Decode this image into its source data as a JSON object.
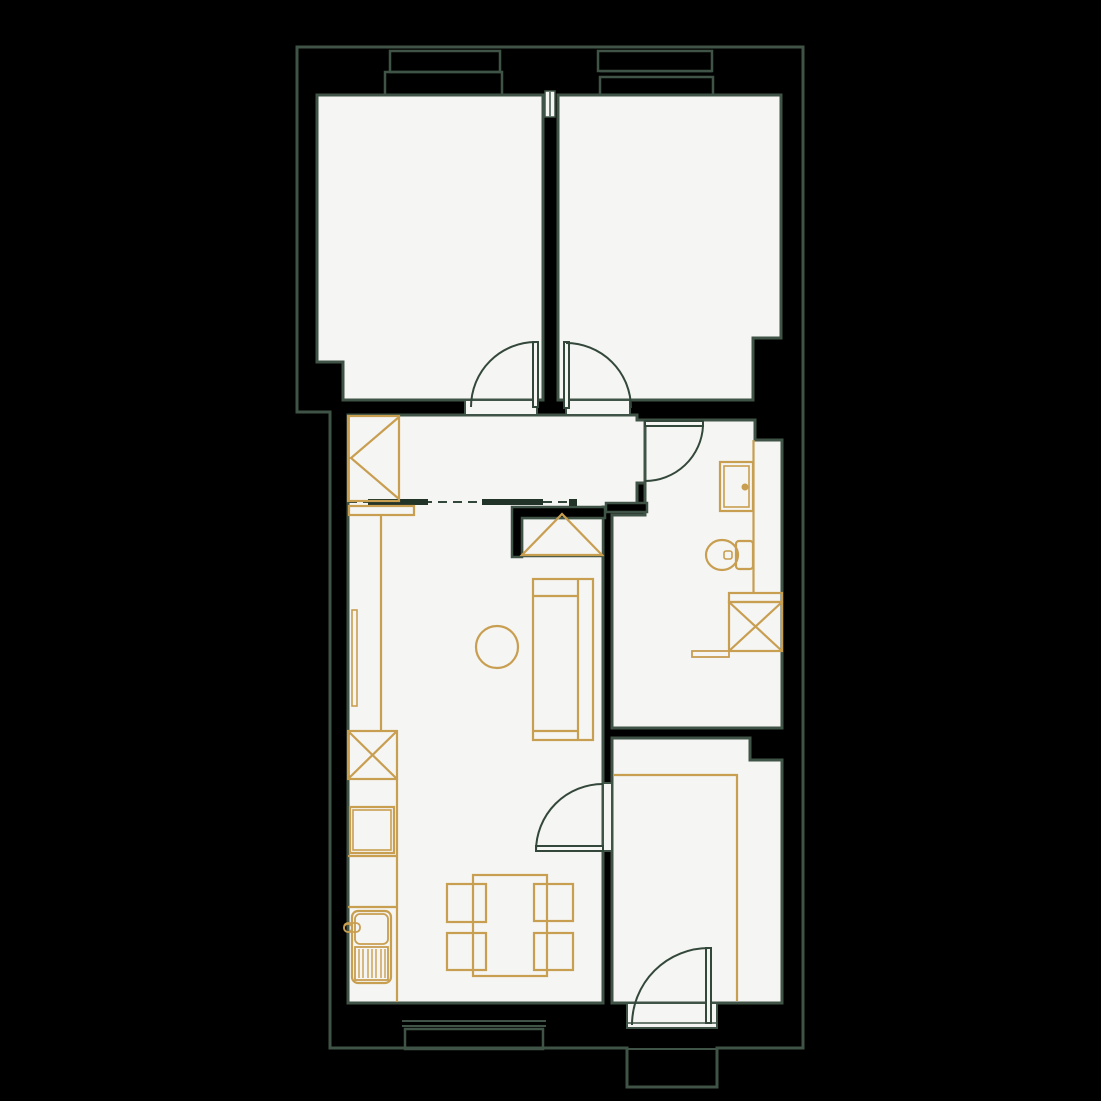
{
  "palette": {
    "bg": "#000000",
    "line": "#3f5446",
    "door": "#33473a",
    "floor": "#f5f5f3",
    "gold": "#c89e50",
    "beam": "#223428"
  },
  "canvas": {
    "width": 1101,
    "height": 1101
  },
  "layers": [
    {
      "name": "floors",
      "style": {
        "f": "$floor",
        "s": "$line",
        "w": 3
      },
      "shapes": [
        {
          "n": "bedroom-left-floor",
          "k": "path",
          "d": "M317,95 H543 V400 H343 V362 H317 Z"
        },
        {
          "n": "bedroom-right-floor",
          "k": "path",
          "d": "M558,95 H781 V338 H753 V400 H558 Z"
        },
        {
          "n": "hall-living-floor",
          "k": "path",
          "d": "M348,415 H637 V420 H645 V483 H637 V507 H603 V1003 H348 Z"
        },
        {
          "n": "bathroom-floor",
          "k": "path",
          "d": "M645,420 H755 V440 H782 V728 H612 V515 H645 Z"
        },
        {
          "n": "bottom-room-floor",
          "k": "path",
          "d": "M612,738 H750 V760 H782 V1003 H612 Z"
        },
        {
          "n": "closet-niche-floor",
          "k": "rect",
          "x": 522,
          "y": 518,
          "wd": 81,
          "h": 38,
          "w": 2.5
        },
        {
          "n": "threshold-bedroom-left-door",
          "k": "rect",
          "x": 465,
          "y": 400,
          "wd": 72,
          "h": 15,
          "w": 2
        },
        {
          "n": "threshold-bedroom-right-door",
          "k": "rect",
          "x": 566,
          "y": 400,
          "wd": 64,
          "h": 15,
          "w": 2
        },
        {
          "n": "threshold-bottom-room-door",
          "k": "rect",
          "x": 603,
          "y": 783,
          "wd": 9,
          "h": 68,
          "w": 2
        },
        {
          "n": "threshold-entry-door",
          "k": "rect",
          "x": 627,
          "y": 1003,
          "wd": 90,
          "h": 25,
          "w": 2
        },
        {
          "n": "wall-cap-between-windows",
          "k": "rect",
          "x": 545,
          "y": 91,
          "wd": 10,
          "h": 26,
          "w": 1.5
        }
      ]
    },
    {
      "name": "interior-walls",
      "style": {
        "f": "$bg",
        "s": "$line",
        "w": 2.5
      },
      "shapes": [
        {
          "n": "closet-wall",
          "k": "path",
          "d": "M512,507 H605 V518 H522 V557 H512 Z"
        },
        {
          "n": "hall-bathroom-wall",
          "k": "rect",
          "x": 606,
          "y": 503,
          "wd": 41,
          "h": 9
        }
      ]
    },
    {
      "name": "outer-boundary",
      "style": {
        "f": "none",
        "s": "$line",
        "w": 3
      },
      "shapes": [
        {
          "n": "building-outline",
          "k": "path",
          "d": "M297,47 H803 V1048 H717 V1087 H627 V1048 H330 V412 H297 Z"
        }
      ]
    },
    {
      "name": "windows",
      "style": {
        "f": "none",
        "s": "$line",
        "w": 2.5
      },
      "shapes": [
        {
          "n": "window-left-frame",
          "k": "rect",
          "x": 390,
          "y": 51,
          "wd": 110,
          "h": 21
        },
        {
          "n": "window-left-sill",
          "k": "rect",
          "x": 385,
          "y": 72,
          "wd": 117,
          "h": 23
        },
        {
          "n": "window-right-frame",
          "k": "rect",
          "x": 598,
          "y": 51,
          "wd": 114,
          "h": 20
        },
        {
          "n": "window-right-glass-line",
          "k": "line",
          "x1": 600,
          "y1": 71.5,
          "x2": 712,
          "y2": 71.5,
          "w": 1.5
        },
        {
          "n": "window-right-sill",
          "k": "rect",
          "x": 600,
          "y": 77,
          "wd": 113,
          "h": 18
        },
        {
          "n": "window-bottom-glass-line-a",
          "k": "line",
          "x1": 402,
          "y1": 1021,
          "x2": 546,
          "y2": 1021,
          "w": 2
        },
        {
          "n": "window-bottom-glass-line-b",
          "k": "line",
          "x1": 402,
          "y1": 1026,
          "x2": 546,
          "y2": 1026,
          "w": 2
        },
        {
          "n": "window-bottom-sill",
          "k": "rect",
          "x": 405,
          "y": 1029,
          "wd": 138,
          "h": 20
        },
        {
          "n": "wall-cap-line",
          "k": "line",
          "x1": 550,
          "y1": 92,
          "x2": 550,
          "y2": 116,
          "w": 1.5
        },
        {
          "n": "entry-step-line",
          "k": "line",
          "x1": 627,
          "y1": 1049,
          "x2": 717,
          "y2": 1049,
          "w": 2
        },
        {
          "n": "entry-threshold-line",
          "k": "line",
          "x1": 627,
          "y1": 1023,
          "x2": 717,
          "y2": 1023,
          "w": 1.5
        }
      ]
    },
    {
      "name": "open-plan-markers",
      "style": {
        "f": "none",
        "s": "$door",
        "w": 2
      },
      "shapes": [
        {
          "n": "open-boundary-dashed-line",
          "k": "line",
          "x1": 348,
          "y1": 502,
          "x2": 575,
          "y2": 502,
          "dash": "9 6"
        },
        {
          "n": "ceiling-beam-a",
          "k": "rect",
          "x": 368,
          "y": 499,
          "wd": 60,
          "h": 6,
          "f": "$beam",
          "s": "none"
        },
        {
          "n": "ceiling-beam-b",
          "k": "rect",
          "x": 482,
          "y": 499,
          "wd": 61,
          "h": 6,
          "f": "$beam",
          "s": "none"
        },
        {
          "n": "ceiling-beam-end",
          "k": "rect",
          "x": 569,
          "y": 499,
          "wd": 8,
          "h": 7,
          "f": "$beam",
          "s": "none"
        }
      ]
    },
    {
      "name": "doors",
      "style": {
        "f": "none",
        "s": "$door",
        "w": 2
      },
      "shapes": [
        {
          "n": "bedroom-left-door-leaf",
          "k": "rect",
          "x": 533,
          "y": 342,
          "wd": 5,
          "h": 65,
          "f": "$floor"
        },
        {
          "n": "bedroom-left-door-arc",
          "k": "path",
          "d": "M471,407 A65,65 0 0 1 536,342"
        },
        {
          "n": "bedroom-right-door-leaf",
          "k": "rect",
          "x": 564,
          "y": 342,
          "wd": 5,
          "h": 66,
          "f": "$floor"
        },
        {
          "n": "bedroom-right-door-arc",
          "k": "path",
          "d": "M566,343 A65,65 0 0 1 631,408"
        },
        {
          "n": "bathroom-door-leaf",
          "k": "rect",
          "x": 645,
          "y": 421,
          "wd": 58,
          "h": 5,
          "f": "$floor"
        },
        {
          "n": "bathroom-door-arc",
          "k": "path",
          "d": "M703,426 A58,58 0 0 1 645,481"
        },
        {
          "n": "bottom-room-door-leaf",
          "k": "rect",
          "x": 536,
          "y": 846,
          "wd": 67,
          "h": 5,
          "f": "$floor"
        },
        {
          "n": "bottom-room-door-arc",
          "k": "path",
          "d": "M536,851 A67,67 0 0 1 603,784"
        },
        {
          "n": "entry-door-leaf",
          "k": "rect",
          "x": 706,
          "y": 948,
          "wd": 5,
          "h": 75,
          "f": "$floor"
        },
        {
          "n": "entry-door-arc",
          "k": "path",
          "d": "M632,1025 A77,77 0 0 1 709,948"
        }
      ]
    },
    {
      "name": "furniture",
      "style": {
        "f": "none",
        "s": "$gold",
        "w": 2.2
      },
      "shapes": [
        {
          "n": "hall-wardrobe",
          "k": "rect",
          "x": 348,
          "y": 416,
          "wd": 51,
          "h": 85
        },
        {
          "n": "hall-wardrobe-door-mark",
          "k": "path",
          "d": "M399,417 L351,458 L399,499"
        },
        {
          "n": "closet-wardrobe-mark",
          "k": "path",
          "d": "M522,555 L562,514 L602,555 Z"
        },
        {
          "n": "kitchen-counter-top-band",
          "k": "rect",
          "x": 349,
          "y": 506,
          "wd": 65,
          "h": 9
        },
        {
          "n": "kitchen-counter-upper-edge",
          "k": "line",
          "x1": 381,
          "y1": 515,
          "x2": 381,
          "y2": 731
        },
        {
          "n": "kitchen-radiator",
          "k": "rect",
          "x": 352,
          "y": 610,
          "wd": 5,
          "h": 96,
          "w": 1.6
        },
        {
          "n": "kitchen-appliance-box",
          "k": "rect",
          "x": 348,
          "y": 731,
          "wd": 49,
          "h": 48
        },
        {
          "n": "kitchen-appliance-x",
          "k": "path",
          "d": "M348,731 L397,779 M397,731 L348,779"
        },
        {
          "n": "kitchen-hob-outer",
          "k": "rect",
          "x": 350,
          "y": 807,
          "wd": 44,
          "h": 46
        },
        {
          "n": "kitchen-hob-inner",
          "k": "rect",
          "x": 353,
          "y": 810,
          "wd": 38,
          "h": 40,
          "w": 1.6
        },
        {
          "n": "kitchen-counter-lower-edge",
          "k": "line",
          "x1": 397,
          "y1": 779,
          "x2": 397,
          "y2": 1002
        },
        {
          "n": "kitchen-counter-divider-a",
          "k": "line",
          "x1": 348,
          "y1": 856,
          "x2": 397,
          "y2": 856
        },
        {
          "n": "kitchen-counter-divider-b",
          "k": "line",
          "x1": 348,
          "y1": 907,
          "x2": 397,
          "y2": 907
        },
        {
          "n": "kitchen-sink-unit",
          "k": "rect",
          "x": 352,
          "y": 911,
          "wd": 39,
          "h": 72,
          "rx": 6
        },
        {
          "n": "kitchen-sink-basin",
          "k": "rect",
          "x": 355,
          "y": 914,
          "wd": 33,
          "h": 30,
          "rx": 5,
          "w": 1.8
        },
        {
          "n": "kitchen-sink-drainer",
          "k": "rect",
          "x": 355,
          "y": 947,
          "wd": 33,
          "h": 33,
          "w": 1.8
        },
        {
          "n": "kitchen-sink-drainer-ridges",
          "k": "path",
          "d": "M359,949 V978 M363,949 V978 M368,949 V978 M372,949 V978 M376,949 V978 M381,949 V978 M385,949 V978",
          "w": 1.4
        },
        {
          "n": "kitchen-faucet",
          "k": "rect",
          "x": 344,
          "y": 923,
          "wd": 16,
          "h": 9,
          "rx": 4,
          "w": 1.8
        },
        {
          "n": "kitchen-faucet-knob",
          "k": "circle",
          "cx": 348,
          "cy": 928,
          "r": 4,
          "w": 1.6
        },
        {
          "n": "dining-table",
          "k": "rect",
          "x": 473,
          "y": 875,
          "wd": 74,
          "h": 101
        },
        {
          "n": "dining-chair-top-left",
          "k": "rect",
          "x": 447,
          "y": 884,
          "wd": 39,
          "h": 38
        },
        {
          "n": "dining-chair-top-right",
          "k": "rect",
          "x": 534,
          "y": 884,
          "wd": 39,
          "h": 37
        },
        {
          "n": "dining-chair-bottom-left",
          "k": "rect",
          "x": 447,
          "y": 933,
          "wd": 39,
          "h": 37
        },
        {
          "n": "dining-chair-bottom-right",
          "k": "rect",
          "x": 534,
          "y": 933,
          "wd": 39,
          "h": 37
        },
        {
          "n": "side-table-round",
          "k": "circle",
          "cx": 497,
          "cy": 647,
          "r": 21
        },
        {
          "n": "sofa-outline",
          "k": "rect",
          "x": 533,
          "y": 579,
          "wd": 60,
          "h": 161
        },
        {
          "n": "sofa-backrest-line",
          "k": "line",
          "x1": 578,
          "y1": 579,
          "x2": 578,
          "y2": 740
        },
        {
          "n": "sofa-armrest-top",
          "k": "line",
          "x1": 533,
          "y1": 596,
          "x2": 578,
          "y2": 596
        },
        {
          "n": "sofa-armrest-bottom",
          "k": "line",
          "x1": 533,
          "y1": 731,
          "x2": 578,
          "y2": 731
        },
        {
          "n": "bottom-room-bed",
          "k": "path",
          "d": "M614,775 H737 V1001"
        },
        {
          "n": "bathroom-counter-edge",
          "k": "line",
          "x1": 753.5,
          "y1": 440,
          "x2": 753.5,
          "y2": 593
        },
        {
          "n": "washbasin-outer",
          "k": "rect",
          "x": 720,
          "y": 462,
          "wd": 33,
          "h": 49
        },
        {
          "n": "washbasin-inner",
          "k": "rect",
          "x": 724,
          "y": 466,
          "wd": 25,
          "h": 41,
          "w": 1.6
        },
        {
          "n": "washbasin-drain-dot",
          "k": "circle",
          "cx": 745,
          "cy": 487,
          "r": 3.5,
          "f": "$gold",
          "s": "none"
        },
        {
          "n": "toilet-bowl",
          "k": "ellipse",
          "cx": 722,
          "cy": 555,
          "rx": 16,
          "ry": 15
        },
        {
          "n": "toilet-tank",
          "k": "rect",
          "x": 736,
          "y": 541,
          "wd": 17,
          "h": 28,
          "rx": 3
        },
        {
          "n": "toilet-flush-handle",
          "k": "rect",
          "x": 724,
          "y": 551,
          "wd": 8,
          "h": 8,
          "rx": 2,
          "w": 1.6
        },
        {
          "n": "washing-machine-top-band",
          "k": "rect",
          "x": 729,
          "y": 593,
          "wd": 53,
          "h": 9
        },
        {
          "n": "washing-machine-box",
          "k": "rect",
          "x": 729,
          "y": 602,
          "wd": 53,
          "h": 49
        },
        {
          "n": "washing-machine-x",
          "k": "path",
          "d": "M729,602 L782,651 M782,602 L729,651"
        },
        {
          "n": "bathroom-ledge",
          "k": "rect",
          "x": 692,
          "y": 651,
          "wd": 37,
          "h": 6,
          "w": 1.8
        }
      ]
    }
  ]
}
